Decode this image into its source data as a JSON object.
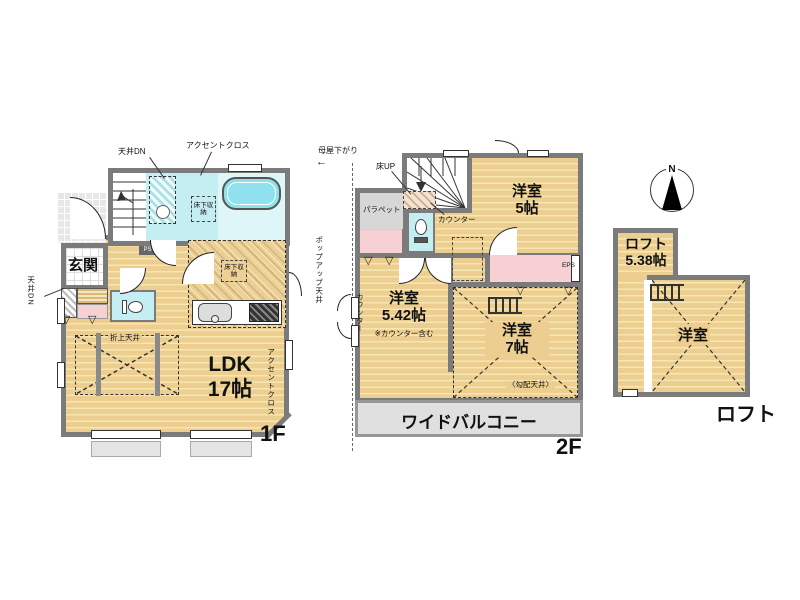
{
  "colors": {
    "wall": "#7b7b7b",
    "floor_tan": "#eccf90",
    "floor_stripe": "#f7e6b0",
    "water_cyan": "#c4eef2",
    "tub_cyan": "#8fe2ed",
    "closet_pink": "#f7d0d4",
    "balcony_gray": "#e0e0e0",
    "parapet_gray": "#d7d7d7"
  },
  "icons": {
    "arrow_left": "←",
    "triangle_down": "▽"
  },
  "floor1": {
    "floor_label": "1F",
    "rooms": {
      "entrance": "玄関",
      "ldk": "LDK",
      "ldk_size": "17帖"
    },
    "annotations": {
      "ceiling_dn_top": "天井DN",
      "accent_cloth_top": "アクセントクロス",
      "ceiling_dn_left": "天井DN",
      "accent_cloth_side": "アクセントクロス",
      "coffered_ceiling": "折上天井",
      "pipe_space": "PS",
      "underfloor_storage_washroom": "床下収納",
      "underfloor_storage_kitchen": "床下収納"
    }
  },
  "floor2": {
    "floor_label": "2F",
    "rooms": {
      "western_room_5": "洋室",
      "western_room_5_size": "5帖",
      "western_room_542": "洋室",
      "western_room_542_size": "5.42帖",
      "western_room_7": "洋室",
      "western_room_7_size": "7帖",
      "wide_balcony": "ワイドバルコニー"
    },
    "annotations": {
      "main_roof_down": "母屋下がり",
      "popup_ceiling": "ポップアップ天井",
      "floor_up": "床UP",
      "parapet": "パラペット",
      "counter_stairs": "カウンター",
      "counter_side": "カウンター",
      "counter_note": "※カウンター含む",
      "sloped_ceiling": "〈勾配天井〉",
      "eps": "EPS"
    }
  },
  "loft": {
    "floor_label": "ロフト",
    "compass_n": "N",
    "rooms": {
      "loft": "ロフト",
      "loft_size": "5.38帖",
      "western_room": "洋室"
    }
  }
}
